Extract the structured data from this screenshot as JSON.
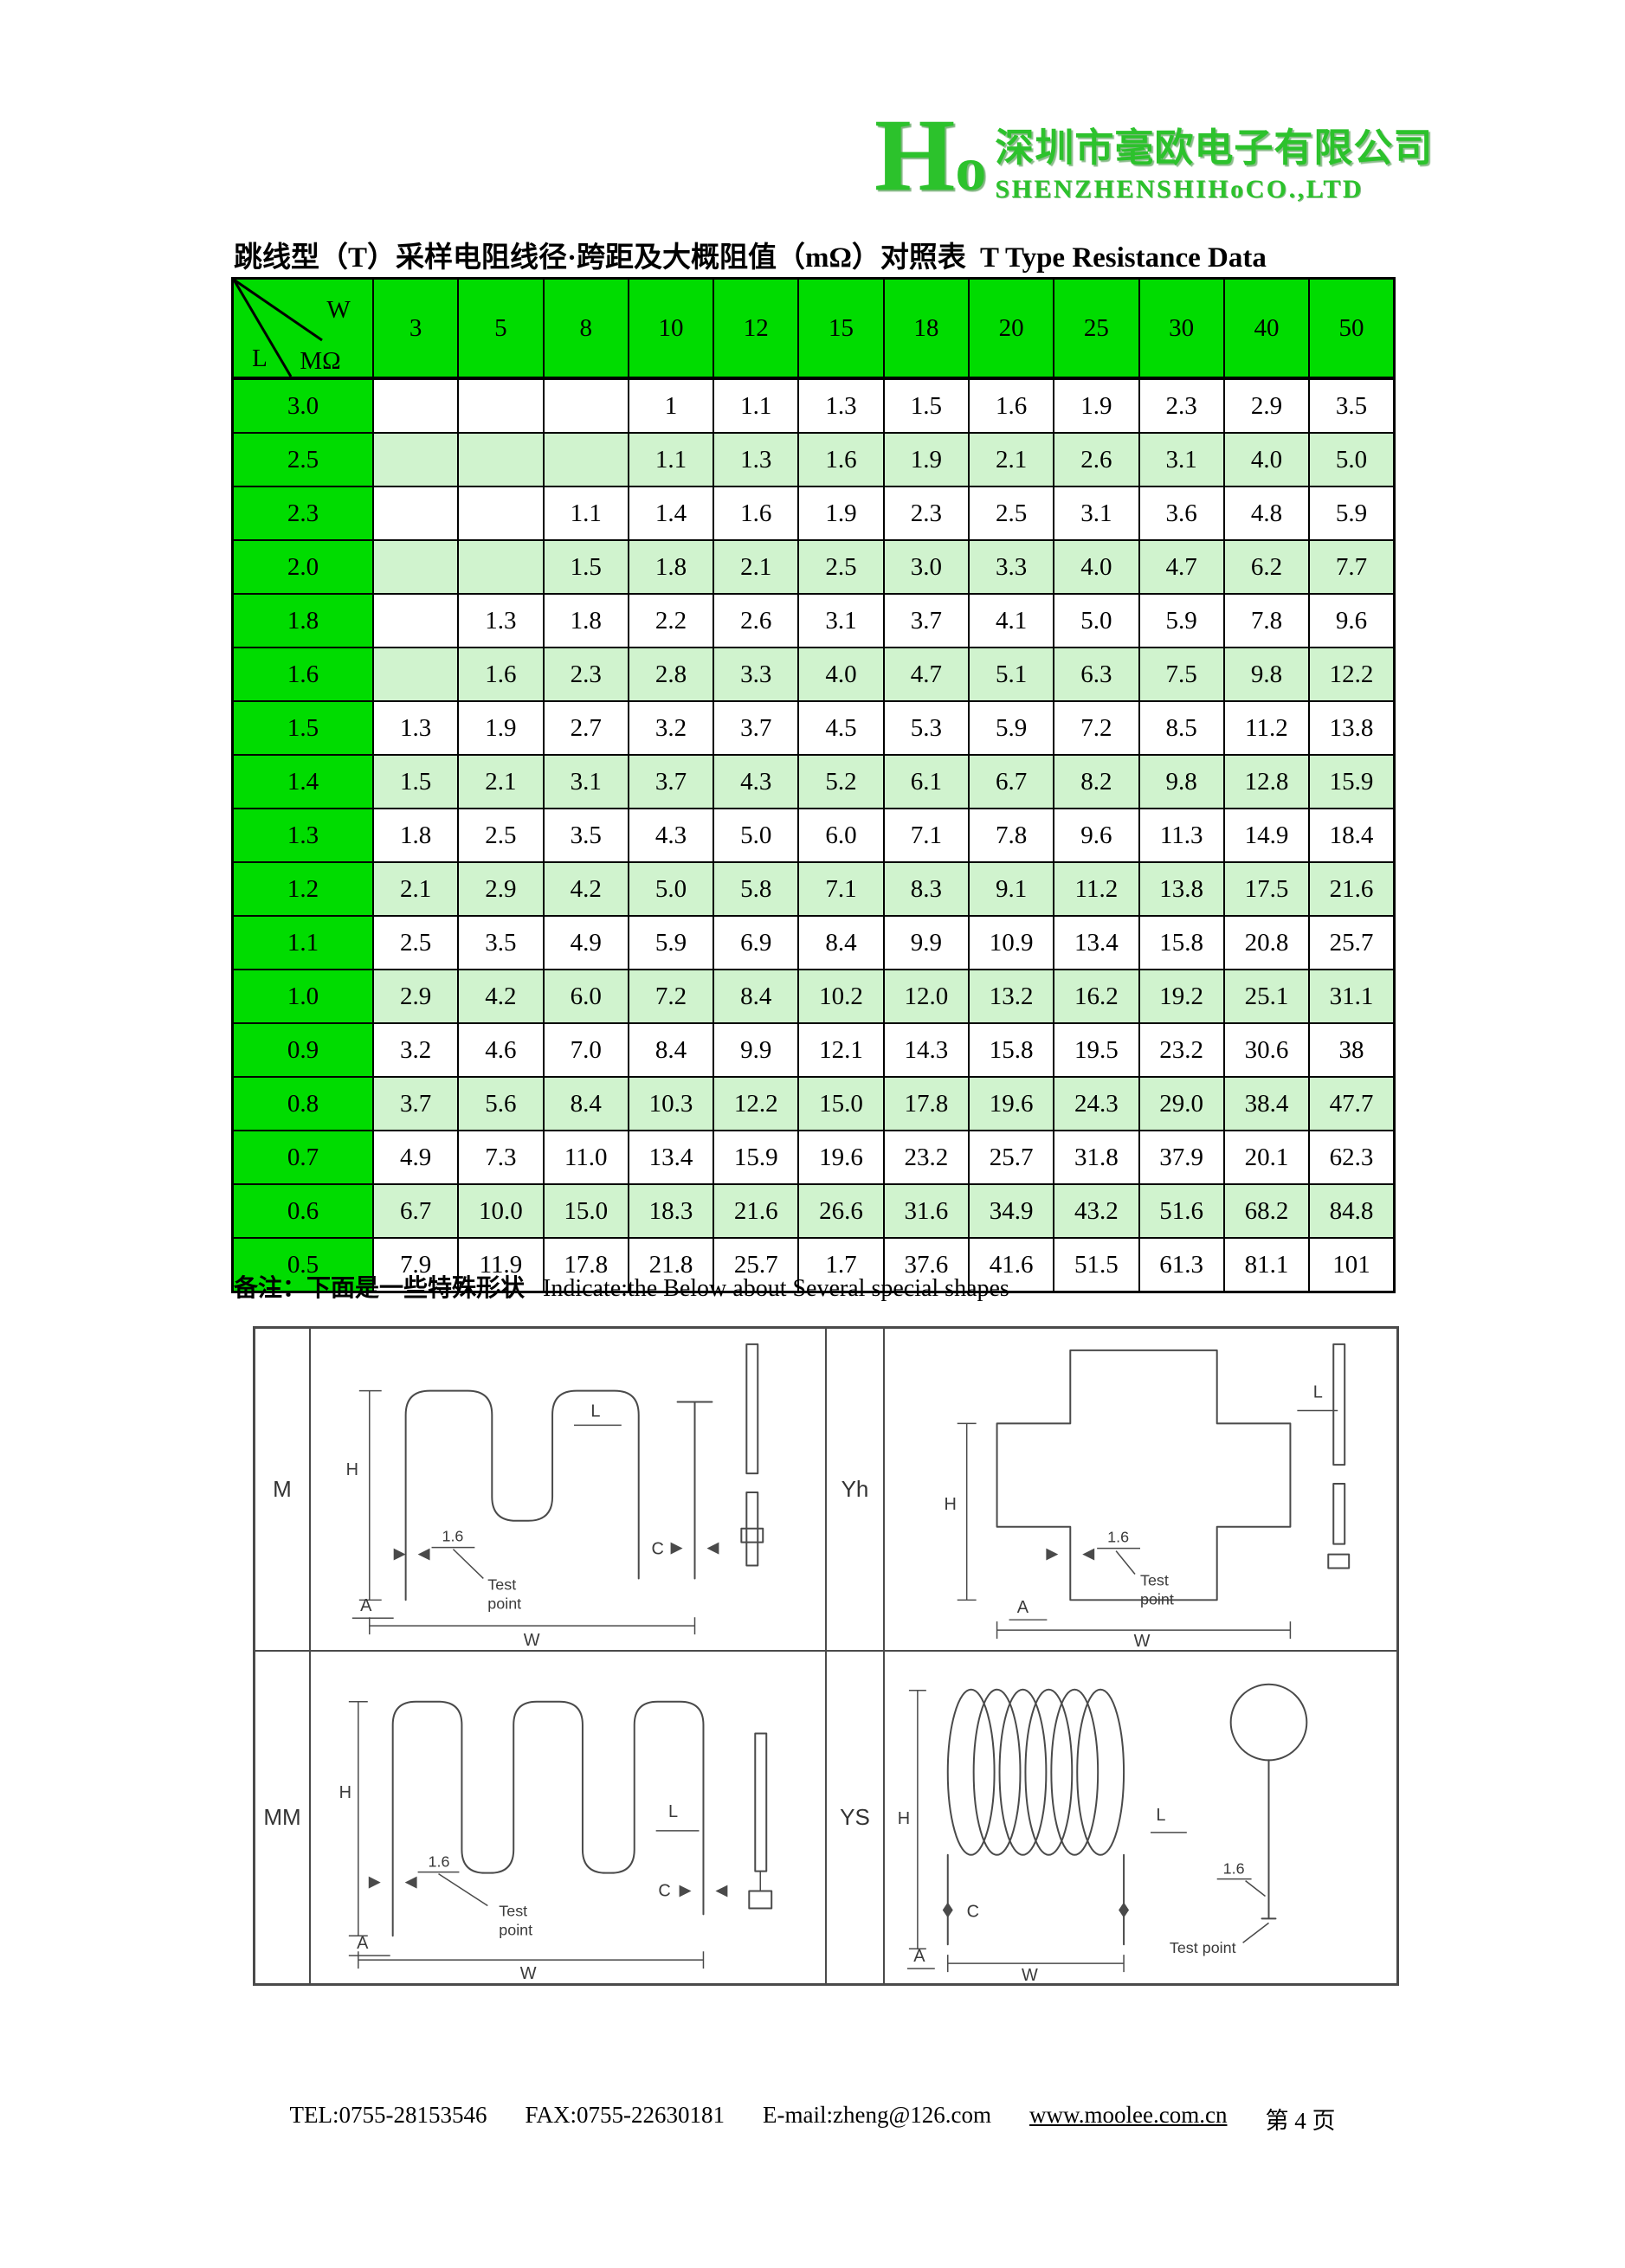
{
  "logo": {
    "mark": "Ho",
    "company_cn": "深圳市毫欧电子有限公司",
    "company_en": "SHENZHENSHIHoCO.,LTD"
  },
  "title": {
    "cn": "跳线型（T）采样电阻线径·跨距及大概阻值（mΩ）对照表",
    "en": "T Type Resistance Data"
  },
  "table": {
    "corner": {
      "w": "W",
      "l": "L",
      "mohm": "MΩ"
    },
    "columns": [
      "3",
      "5",
      "8",
      "10",
      "12",
      "15",
      "18",
      "20",
      "25",
      "30",
      "40",
      "50"
    ],
    "rows": [
      {
        "label": "3.0",
        "values": [
          "",
          "",
          "",
          "1",
          "1.1",
          "1.3",
          "1.5",
          "1.6",
          "1.9",
          "2.3",
          "2.9",
          "3.5"
        ]
      },
      {
        "label": "2.5",
        "values": [
          "",
          "",
          "",
          "1.1",
          "1.3",
          "1.6",
          "1.9",
          "2.1",
          "2.6",
          "3.1",
          "4.0",
          "5.0"
        ]
      },
      {
        "label": "2.3",
        "values": [
          "",
          "",
          "1.1",
          "1.4",
          "1.6",
          "1.9",
          "2.3",
          "2.5",
          "3.1",
          "3.6",
          "4.8",
          "5.9"
        ]
      },
      {
        "label": "2.0",
        "values": [
          "",
          "",
          "1.5",
          "1.8",
          "2.1",
          "2.5",
          "3.0",
          "3.3",
          "4.0",
          "4.7",
          "6.2",
          "7.7"
        ]
      },
      {
        "label": "1.8",
        "values": [
          "",
          "1.3",
          "1.8",
          "2.2",
          "2.6",
          "3.1",
          "3.7",
          "4.1",
          "5.0",
          "5.9",
          "7.8",
          "9.6"
        ]
      },
      {
        "label": "1.6",
        "values": [
          "",
          "1.6",
          "2.3",
          "2.8",
          "3.3",
          "4.0",
          "4.7",
          "5.1",
          "6.3",
          "7.5",
          "9.8",
          "12.2"
        ]
      },
      {
        "label": "1.5",
        "values": [
          "1.3",
          "1.9",
          "2.7",
          "3.2",
          "3.7",
          "4.5",
          "5.3",
          "5.9",
          "7.2",
          "8.5",
          "11.2",
          "13.8"
        ]
      },
      {
        "label": "1.4",
        "values": [
          "1.5",
          "2.1",
          "3.1",
          "3.7",
          "4.3",
          "5.2",
          "6.1",
          "6.7",
          "8.2",
          "9.8",
          "12.8",
          "15.9"
        ]
      },
      {
        "label": "1.3",
        "values": [
          "1.8",
          "2.5",
          "3.5",
          "4.3",
          "5.0",
          "6.0",
          "7.1",
          "7.8",
          "9.6",
          "11.3",
          "14.9",
          "18.4"
        ]
      },
      {
        "label": "1.2",
        "values": [
          "2.1",
          "2.9",
          "4.2",
          "5.0",
          "5.8",
          "7.1",
          "8.3",
          "9.1",
          "11.2",
          "13.8",
          "17.5",
          "21.6"
        ]
      },
      {
        "label": "1.1",
        "values": [
          "2.5",
          "3.5",
          "4.9",
          "5.9",
          "6.9",
          "8.4",
          "9.9",
          "10.9",
          "13.4",
          "15.8",
          "20.8",
          "25.7"
        ]
      },
      {
        "label": "1.0",
        "values": [
          "2.9",
          "4.2",
          "6.0",
          "7.2",
          "8.4",
          "10.2",
          "12.0",
          "13.2",
          "16.2",
          "19.2",
          "25.1",
          "31.1"
        ]
      },
      {
        "label": "0.9",
        "values": [
          "3.2",
          "4.6",
          "7.0",
          "8.4",
          "9.9",
          "12.1",
          "14.3",
          "15.8",
          "19.5",
          "23.2",
          "30.6",
          "38"
        ]
      },
      {
        "label": "0.8",
        "values": [
          "3.7",
          "5.6",
          "8.4",
          "10.3",
          "12.2",
          "15.0",
          "17.8",
          "19.6",
          "24.3",
          "29.0",
          "38.4",
          "47.7"
        ]
      },
      {
        "label": "0.7",
        "values": [
          "4.9",
          "7.3",
          "11.0",
          "13.4",
          "15.9",
          "19.6",
          "23.2",
          "25.7",
          "31.8",
          "37.9",
          "20.1",
          "62.3"
        ]
      },
      {
        "label": "0.6",
        "values": [
          "6.7",
          "10.0",
          "15.0",
          "18.3",
          "21.6",
          "26.6",
          "31.6",
          "34.9",
          "43.2",
          "51.6",
          "68.2",
          "84.8"
        ]
      },
      {
        "label": "0.5",
        "values": [
          "7.9",
          "11.9",
          "17.8",
          "21.8",
          "25.7",
          "1.7",
          "37.6",
          "41.6",
          "51.5",
          "61.3",
          "81.1",
          "101"
        ]
      }
    ]
  },
  "note": {
    "cn": "备注：下面是一些特殊形状",
    "en": "Indicate:the Below about Several special shapes"
  },
  "diagrams": {
    "sections": [
      {
        "label": "M"
      },
      {
        "label": "Yh"
      },
      {
        "label": "MM"
      },
      {
        "label": "YS"
      }
    ],
    "annot": {
      "h": "H",
      "l": "L",
      "a": "A",
      "c": "C",
      "w": "W",
      "wire_dia": "1.6",
      "test_line1": "Test",
      "test_line2": "point",
      "test_point": "Test point"
    }
  },
  "footer": {
    "tel": "TEL:0755-28153546",
    "fax": "FAX:0755-22630181",
    "email": "E-mail:zheng@126.com",
    "website": "www.moolee.com.cn",
    "page": "第 4 页"
  },
  "colors": {
    "header_green": "#00DC00",
    "row_green": "#D0F3CE",
    "logo_green": "#2CC22C",
    "diagram_line": "#4a4a4a"
  }
}
